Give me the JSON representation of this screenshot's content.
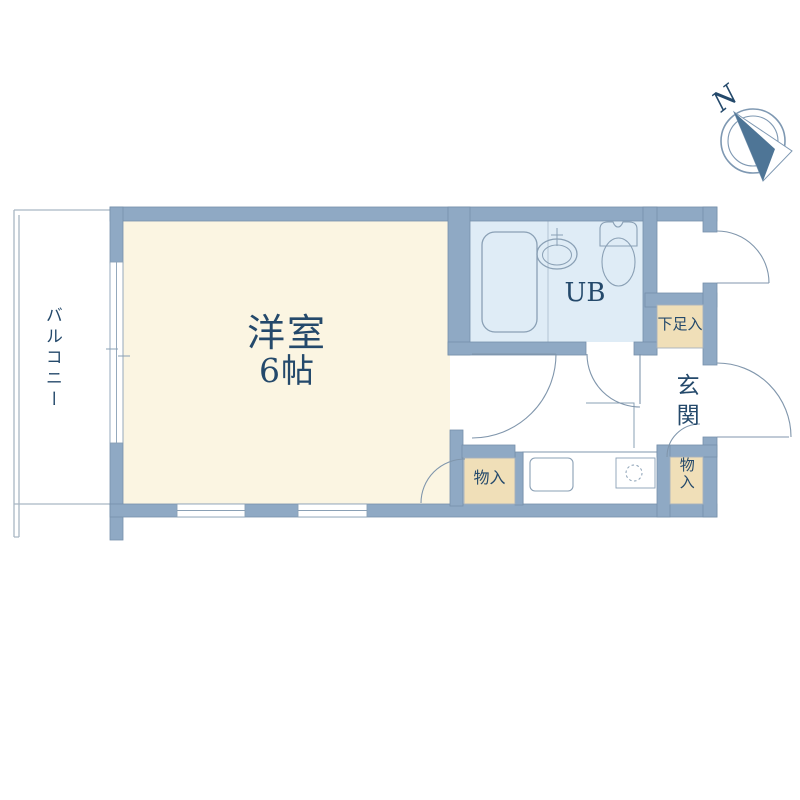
{
  "compass": {
    "north_label": "N"
  },
  "labels": {
    "main_room_name": "洋室",
    "main_room_size": "6帖",
    "balcony": "バルコニー",
    "unit_bath": "UB",
    "shoe_cabinet": "下足入",
    "entrance": "玄関",
    "storage_left": "物入",
    "storage_right": "物入"
  },
  "colors": {
    "wall": "#8fa9c4",
    "wall-edge": "#7690ab",
    "room": "#fbf5e2",
    "bath": "#dfecf6",
    "storage": "#f0dfb8",
    "ink": "#24496b",
    "line": "#8aa0b5",
    "thin": "#a9b7c3",
    "door": "#8096ac",
    "needle": "#4e7596"
  }
}
